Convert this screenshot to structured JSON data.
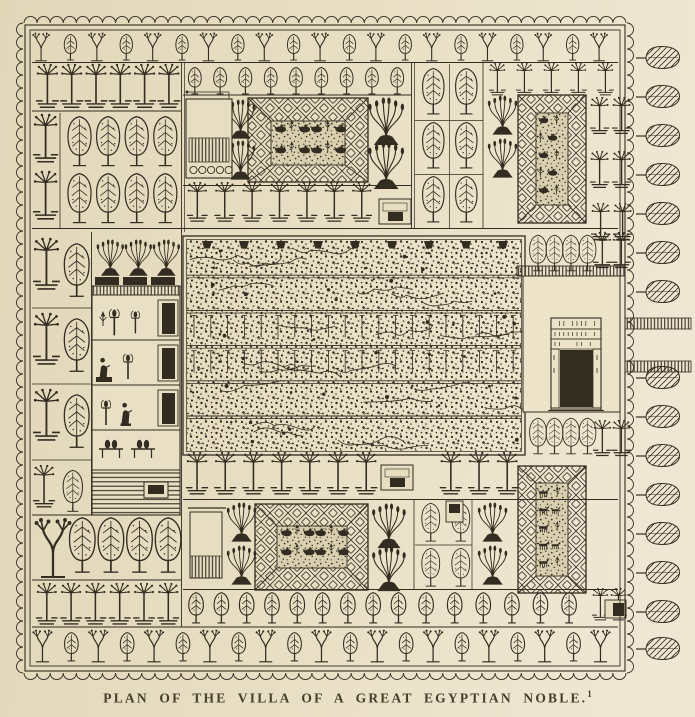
{
  "caption": {
    "text": "PLAN OF THE VILLA OF A GREAT EGYPTIAN NOBLE.",
    "footnote_marker": "1"
  },
  "palette": {
    "paper": "#e7ddc1",
    "paper_light": "#efe7d3",
    "paper_dark": "#e2d7b9",
    "court": "#ece3c9",
    "pond_water": "#d9cfaf",
    "ink": "#332c20",
    "caption_ink": "#463d2b"
  }
}
